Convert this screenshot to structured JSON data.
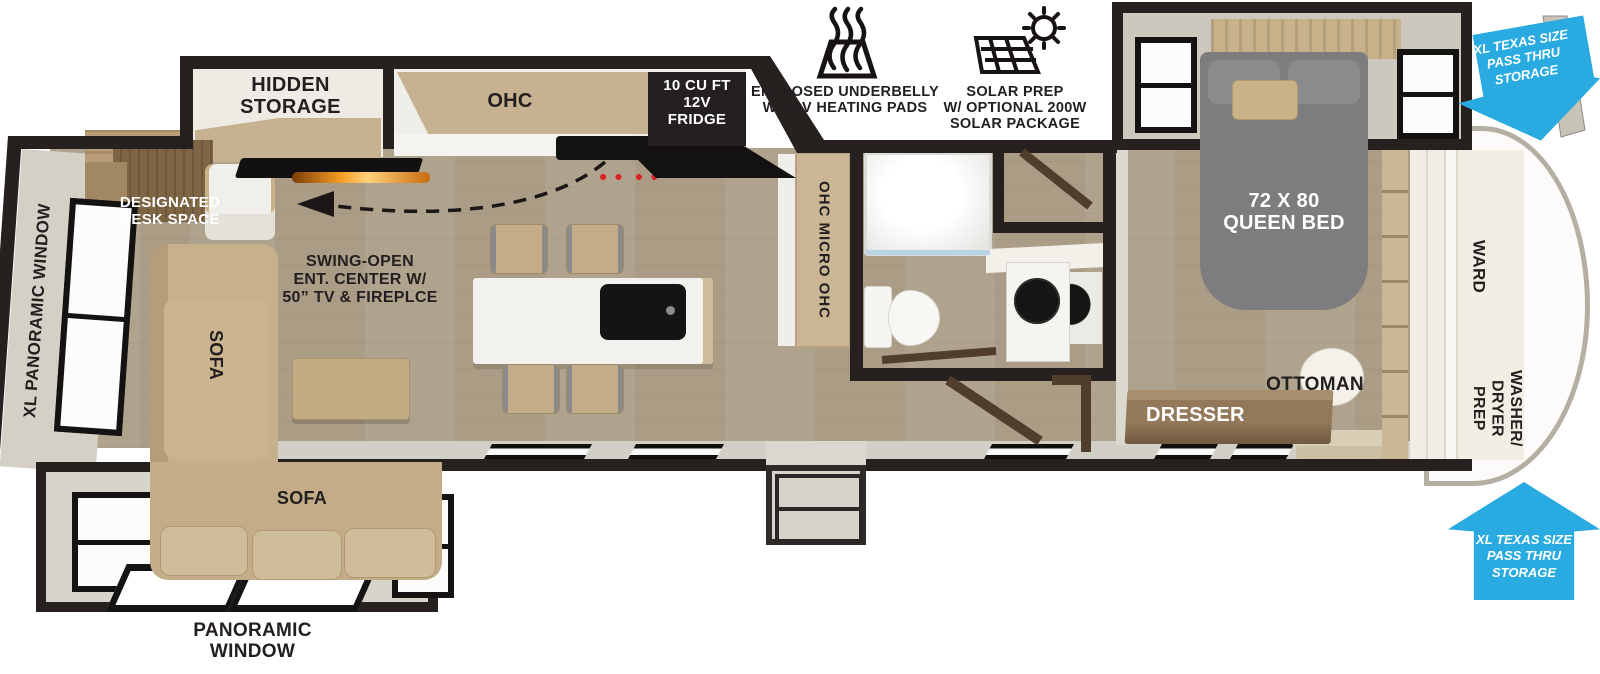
{
  "colors": {
    "wall": "#26211f",
    "text": "#231f20",
    "floor": "#d3cbbc",
    "slide_floor": "#d7d4ca",
    "exterior": "#ccc8bd",
    "cabinet": "#c6b290",
    "wood_dark": "#6e5a41",
    "fixture": "#f4f3ee",
    "sofa": "#c3ac87",
    "bed": "#7d7c7e",
    "blue": "#29abe2",
    "fire": "#e07b1f"
  },
  "labels": {
    "hidden_storage": [
      "HIDDEN",
      "STORAGE"
    ],
    "ohc": "OHC",
    "fridge": [
      "10 CU FT",
      "12V",
      "FRIDGE"
    ],
    "underbelly": [
      "ENCLOSED UNDERBELLY",
      "W/ 12V HEATING PADS"
    ],
    "solar": [
      "SOLAR PREP",
      "W/ OPTIONAL 200W",
      "SOLAR PACKAGE"
    ],
    "queen_bed": [
      "72 X 80",
      "QUEEN BED"
    ],
    "pass_thru": [
      "XL TEXAS SIZE",
      "PASS THRU",
      "STORAGE"
    ],
    "ward": "WARD",
    "washer_dryer": [
      "WASHER/",
      "DRYER",
      "PREP"
    ],
    "ottoman": "OTTOMAN",
    "dresser": "DRESSER",
    "desk": [
      "DESIGNATED",
      "DESK SPACE"
    ],
    "ent_center": [
      "SWING-OPEN",
      "ENT. CENTER W/",
      "50” TV & FIREPLCE"
    ],
    "xl_panoramic": "XL PANORAMIC WINDOW",
    "sofa_chaise": "SOFA",
    "sofa_main": "SOFA",
    "panoramic": [
      "PANORAMIC",
      "WINDOW"
    ],
    "micro": "OHC MICRO OHC"
  }
}
